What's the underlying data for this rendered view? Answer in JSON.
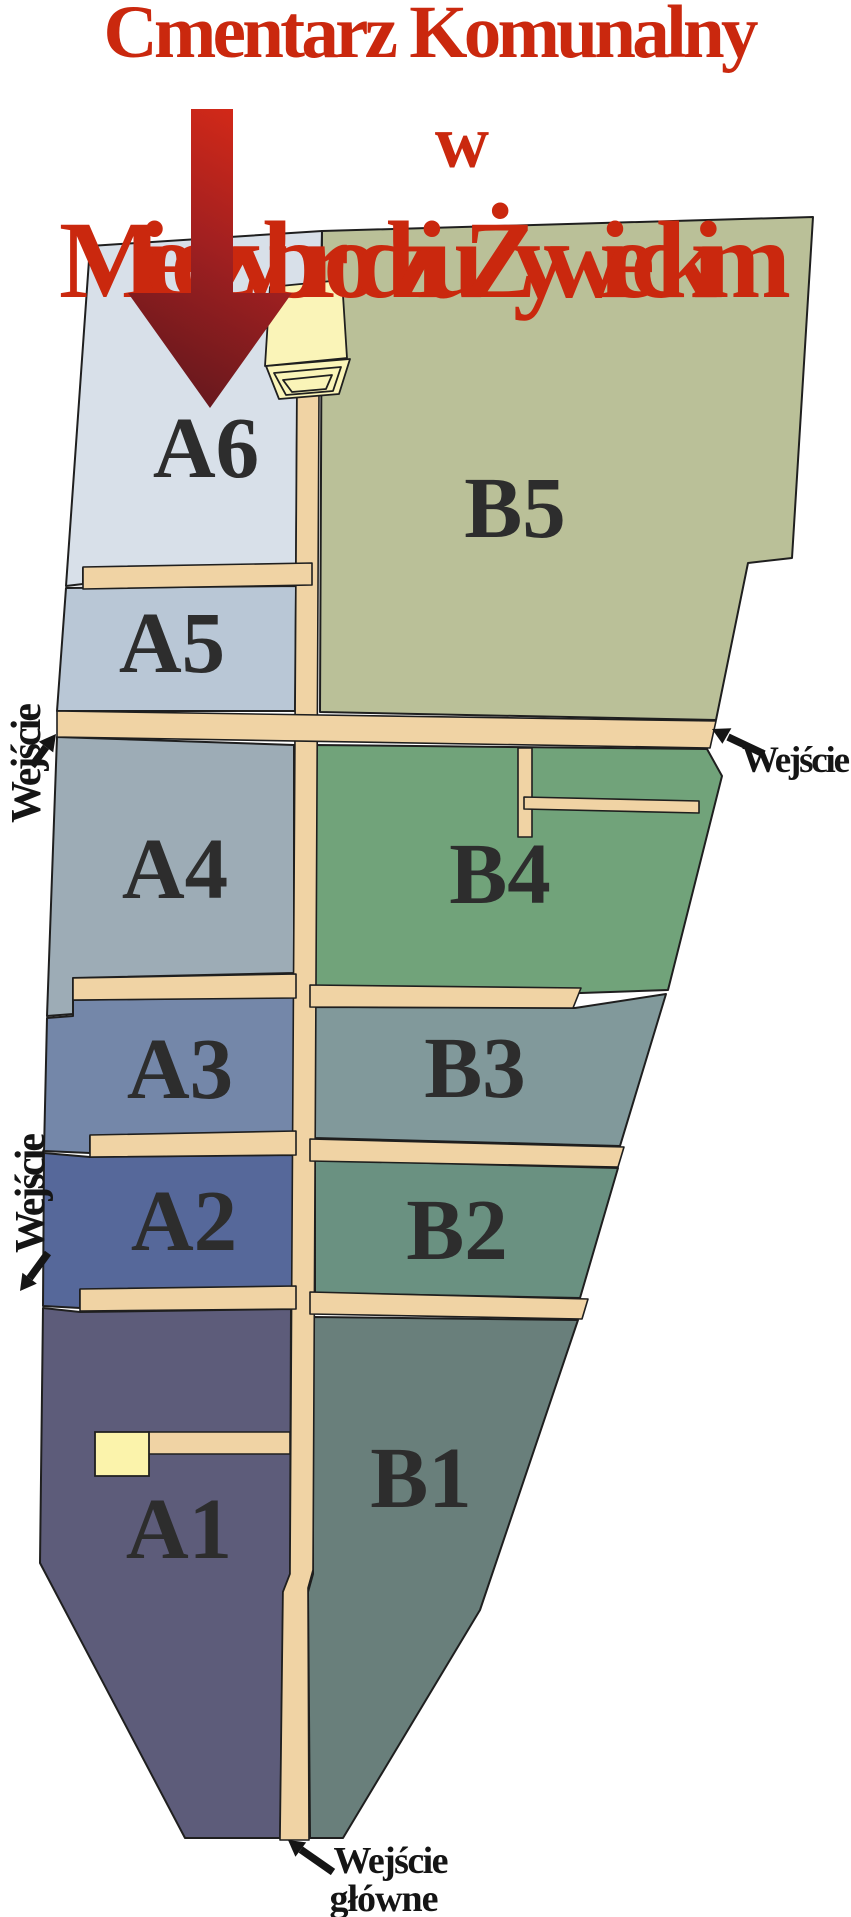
{
  "title": {
    "line1": "Cmentarz Komunalny",
    "line2": "w",
    "line3": "Międzybrodziu Żywieckim",
    "color": "#ca280e"
  },
  "sections": [
    {
      "id": "A1",
      "label": "A1",
      "color": "#5d5c7a"
    },
    {
      "id": "A2",
      "label": "A2",
      "color": "#56689a"
    },
    {
      "id": "A3",
      "label": "A3",
      "color": "#7487a9"
    },
    {
      "id": "A4",
      "label": "A4",
      "color": "#9dacb6"
    },
    {
      "id": "A5",
      "label": "A5",
      "color": "#b9c7d6"
    },
    {
      "id": "A6",
      "label": "A6",
      "color": "#d8e0e9"
    },
    {
      "id": "B1",
      "label": "B1",
      "color": "#697f7b"
    },
    {
      "id": "B2",
      "label": "B2",
      "color": "#6a9181"
    },
    {
      "id": "B3",
      "label": "B3",
      "color": "#81999b"
    },
    {
      "id": "B4",
      "label": "B4",
      "color": "#71a37a"
    },
    {
      "id": "B5",
      "label": "B5",
      "color": "#bac098"
    }
  ],
  "entrances": [
    {
      "id": "left-upper",
      "label": "Wejście"
    },
    {
      "id": "left-lower",
      "label": "Wejście"
    },
    {
      "id": "right",
      "label": "Wejście"
    },
    {
      "id": "main",
      "label_line1": "Wejście",
      "label_line2": "główne"
    }
  ],
  "landmarks": [
    {
      "id": "chapel",
      "color": "#faf4b8"
    },
    {
      "id": "small-building",
      "color": "#fbf3ab"
    }
  ],
  "palette": {
    "path": "#f0d3a4",
    "outline": "#1f1f1f",
    "label": "#2d2d2d",
    "entrance_label": "#151515",
    "arrow_black": "#151515",
    "arrow_dark": "#5e171d",
    "arrow_mid": "#a32020",
    "arrow_bright": "#d92a17",
    "background": "#ffffff"
  }
}
